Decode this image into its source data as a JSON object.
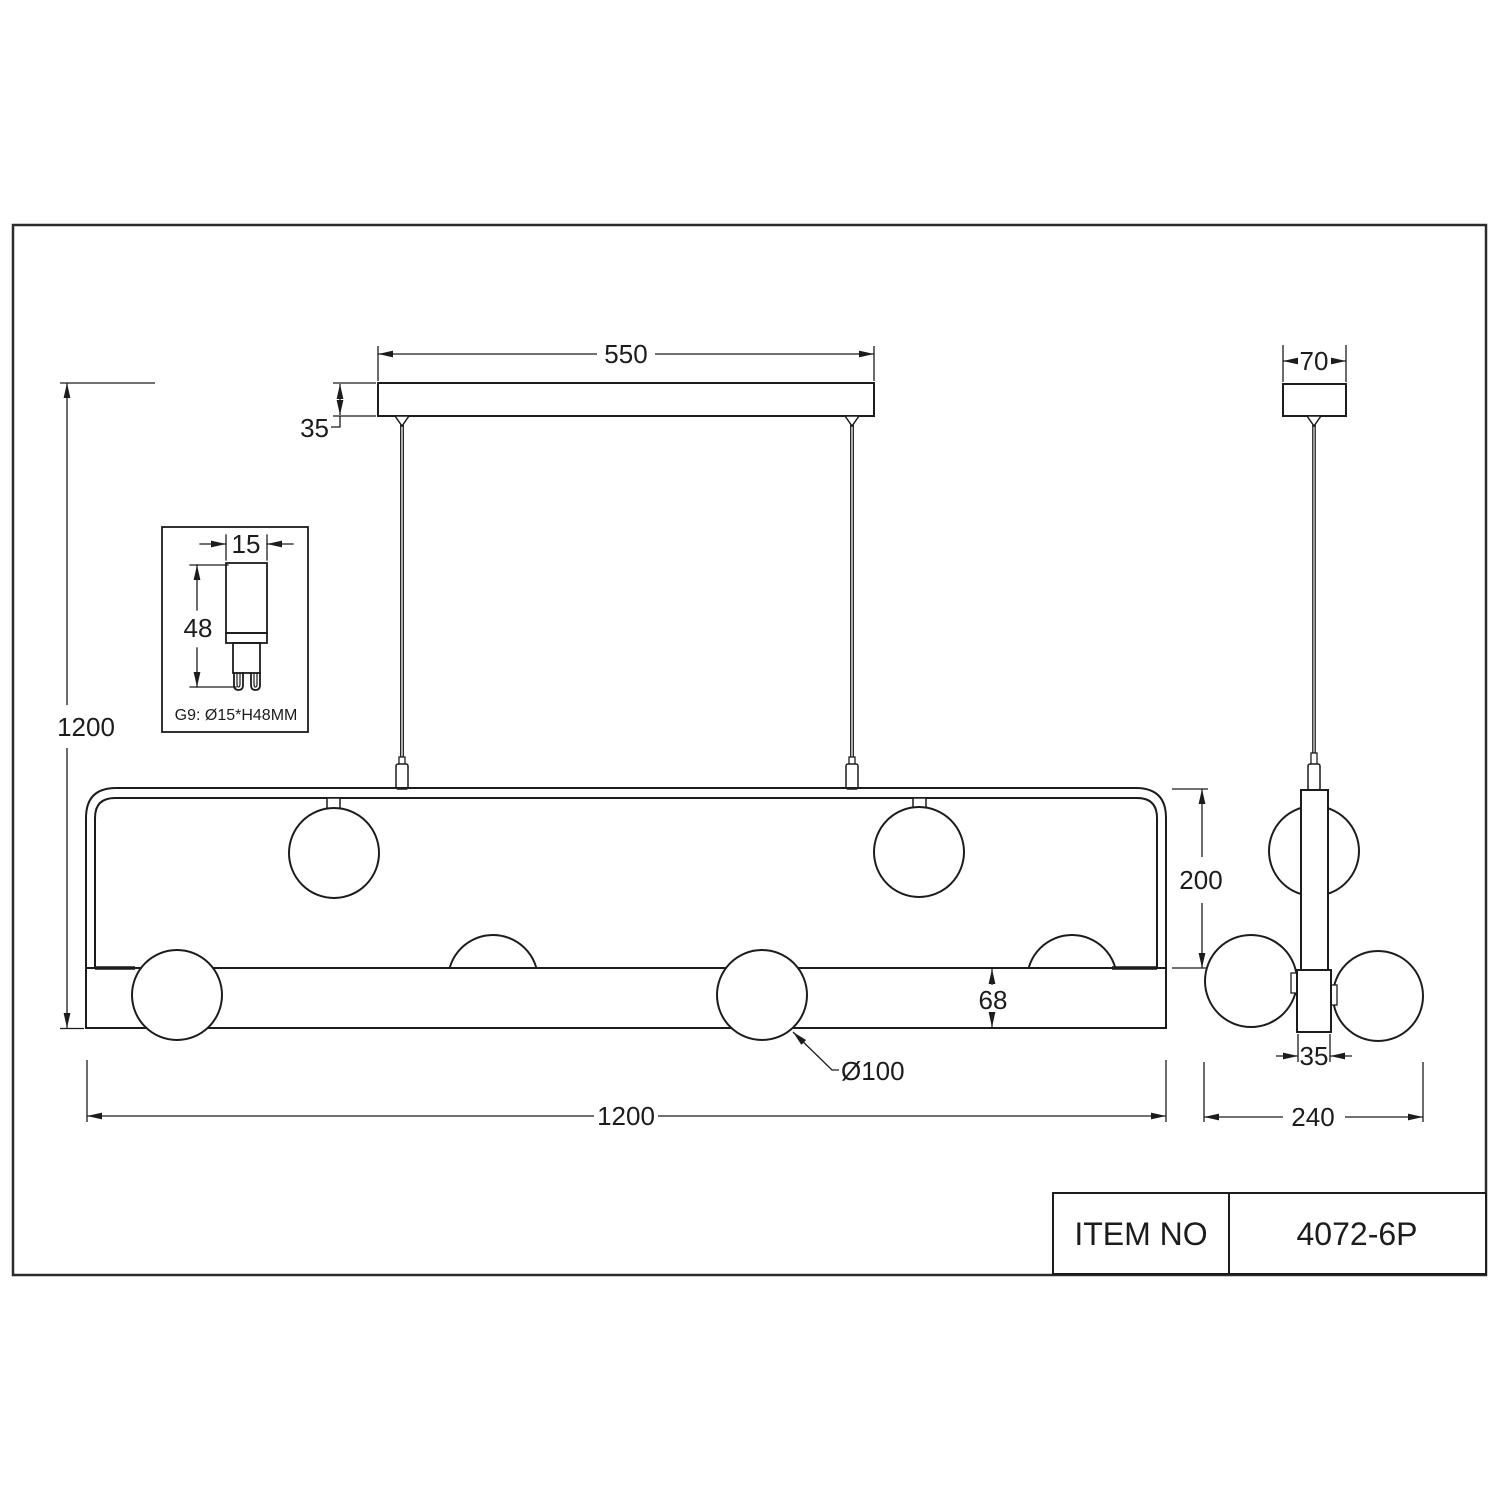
{
  "title_block": {
    "item_no_label": "ITEM NO",
    "item_no_value": "4072-6P"
  },
  "front_view": {
    "canopy_width": "550",
    "canopy_height": "35",
    "overall_height": "1200",
    "frame_length": "1200",
    "frame_height": "200",
    "bar_height": "68",
    "globe_diameter": "Ø100"
  },
  "side_view": {
    "canopy_width": "70",
    "rod_width": "35",
    "overall_width": "240"
  },
  "bulb_detail": {
    "diameter": "15",
    "height": "48",
    "caption": "G9: Ø15*H48MM"
  },
  "colors": {
    "line": "#1c1c1c",
    "border": "#2b2b2b",
    "background": "#ffffff"
  }
}
